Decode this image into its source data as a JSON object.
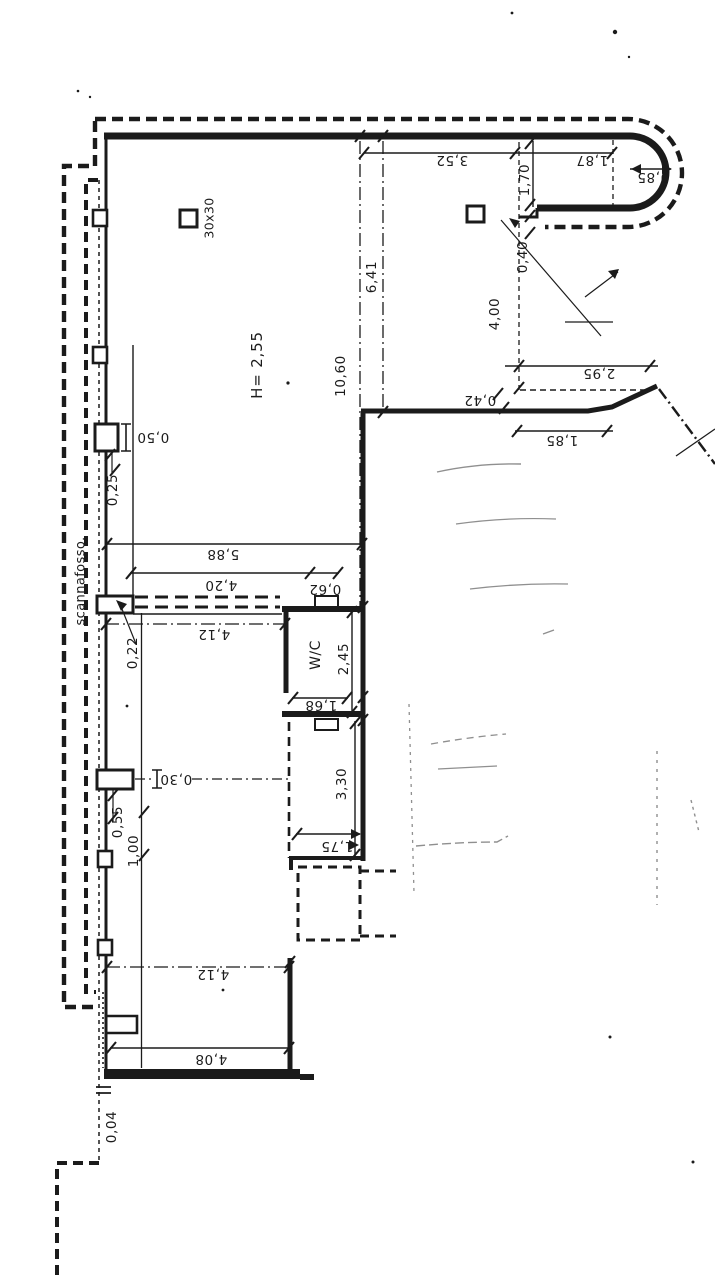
{
  "plan": {
    "area_label": "scannafosso.",
    "room_height": "H= 2,55",
    "pillar_size": "30x30",
    "room_wc": "W/C",
    "colors": {
      "ink": "#1b1b1b",
      "pencil": "#8f8f8f",
      "paper": "#ffffff"
    }
  },
  "labels": {
    "d352": "3,52",
    "d187": "1,87",
    "d085": "0,85",
    "d170": "1,70",
    "d040": "0,40",
    "d400": "4,00",
    "d295": "2,95",
    "d042": "0,42",
    "d185": "1,85",
    "d641": "6,41",
    "d1060": "10,60",
    "d050": "0,50",
    "d025": "0,25",
    "d588": "5,88",
    "d420": "4,20",
    "d062": "0,62",
    "d412_upper": "4,12",
    "d022": "0,22",
    "d245": "2,45",
    "d168": "1,68",
    "d030": "0,30",
    "d330": "3,30",
    "d055": "0,55",
    "d100": "1,00",
    "d175": "1,75",
    "d412_lower": "4,12",
    "d408": "4,08",
    "d004": "0,04"
  }
}
